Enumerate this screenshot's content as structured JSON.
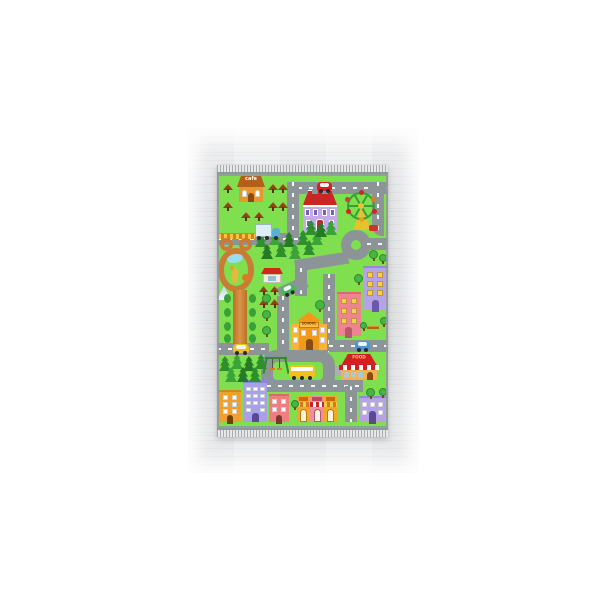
{
  "scene": {
    "description": "Product photo of a children's city-road play rug with fringed ends lying flat on a pale gray wooden floor, centered on a white background",
    "background_color": "#ffffff",
    "floor": "light gray wood planks"
  },
  "rug": {
    "style": "city traffic play mat for kids",
    "labels": {
      "cafe_sign": "cafe",
      "school_sign": "SCHOOL",
      "food_sign": "FOOD"
    },
    "colors": {
      "grass_green": "#80df4e",
      "road_gray": "#8c9498",
      "park_path_orange": "#cd8136",
      "roof_red": "#cc2525",
      "building_orange": "#f0a030",
      "building_pink": "#ec8492",
      "building_lavender": "#b5a3e6",
      "tree_green": "#46b446",
      "pine_green": "#2e8f2e",
      "fringe_gray": "#a6abad"
    },
    "features": [
      "cafe with terrace tables",
      "red-roof mansion",
      "ferris wheel",
      "roundabout",
      "bear-shaped zoo path with pond, giraffe and teepee",
      "pine forest clusters",
      "school building",
      "playground swing set inside road loop",
      "yellow school bus",
      "FOOD fast-food restaurant with striped awning",
      "apartment buildings",
      "shop fronts with striped awnings",
      "red car, blue truck, taxi, blue car, green car"
    ]
  }
}
